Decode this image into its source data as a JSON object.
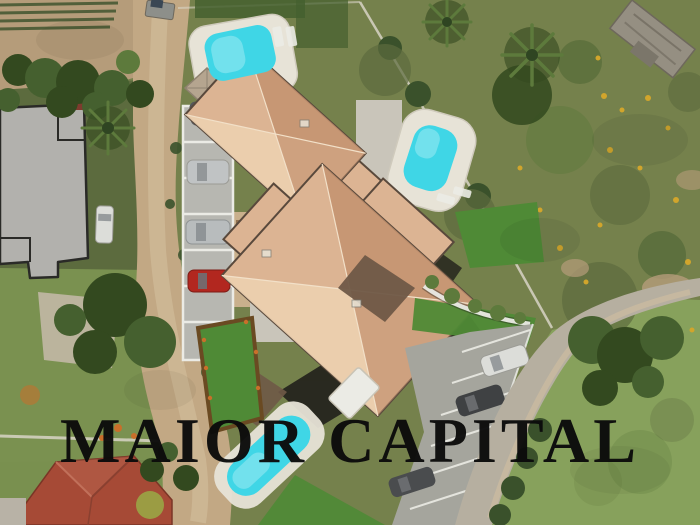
{
  "watermark": {
    "text": "MAIOR CAPITAL",
    "color": "#0b0b0b"
  },
  "scene": {
    "description": "Aerial drone photograph of a Mediterranean villa development with terracotta hip roofs, three turquoise swimming pools, carports with parked cars, a diagonal parking lot and dirt road, neighbouring houses left, wild scrubland with yellow flowers and rubble right",
    "palette": {
      "scrub": "#75814c",
      "scrubDark": "#5c6b3e",
      "grassBR": "#87a15c",
      "grassL": "#7a9150",
      "lawn": "#4f8a36",
      "dirt": "#c2a884",
      "dirtLight": "#d6c1a0",
      "field": "#b59c7a",
      "gravel": "#c0b7a4",
      "roof": "#dcb493",
      "roofLight": "#ecd0b0",
      "roofDark": "#c3926f",
      "roofPatch": "#6f5947",
      "eave": "#59493c",
      "ridge": "#f2e0c8",
      "shadow": "#23221c",
      "poolWater": "#3fd6e6",
      "poolLight": "#a5ecf4",
      "deck": "#e7e3d7",
      "terrace": "#c9c5ba",
      "courtyard": "#c9b08c",
      "pergola": "#8a6a4a",
      "asphalt": "#a5a59d",
      "pad": "#b7b7b1",
      "white": "#ebebe5",
      "grayRoof": "#b2b1ad",
      "edge": "#2a2a27",
      "redStrip": "#7e3b2e",
      "redRoof": "#a64a36",
      "redRoofLight": "#c1705a",
      "redRoofRidge": "#8a4030",
      "road": "#b6afa0",
      "treeDark": "#33491f",
      "tree": "#45602f",
      "treeLight": "#5d7a3c",
      "hedge": "#3a512b",
      "hedgeBorder": "#6a4a22",
      "flowerYellow": "#d1a52c",
      "flowerOrange": "#c96f2a",
      "carRed": "#b2271f",
      "carDark": "#3f4143",
      "carDark2": "#4a4c4e",
      "carSilver": "#c0c3c4",
      "carWhite": "#dcddd9",
      "glass": "#8b8f92",
      "awning": "#b5a58f",
      "awningEdge": "#8f8270",
      "trailer": "#8d8f8a",
      "rubble": "#958f82",
      "rubbleDark": "#6e685c",
      "fence": "#d8d4c6",
      "wallGray": "#b8b2a6",
      "oliveTree": "#9aa545"
    }
  }
}
